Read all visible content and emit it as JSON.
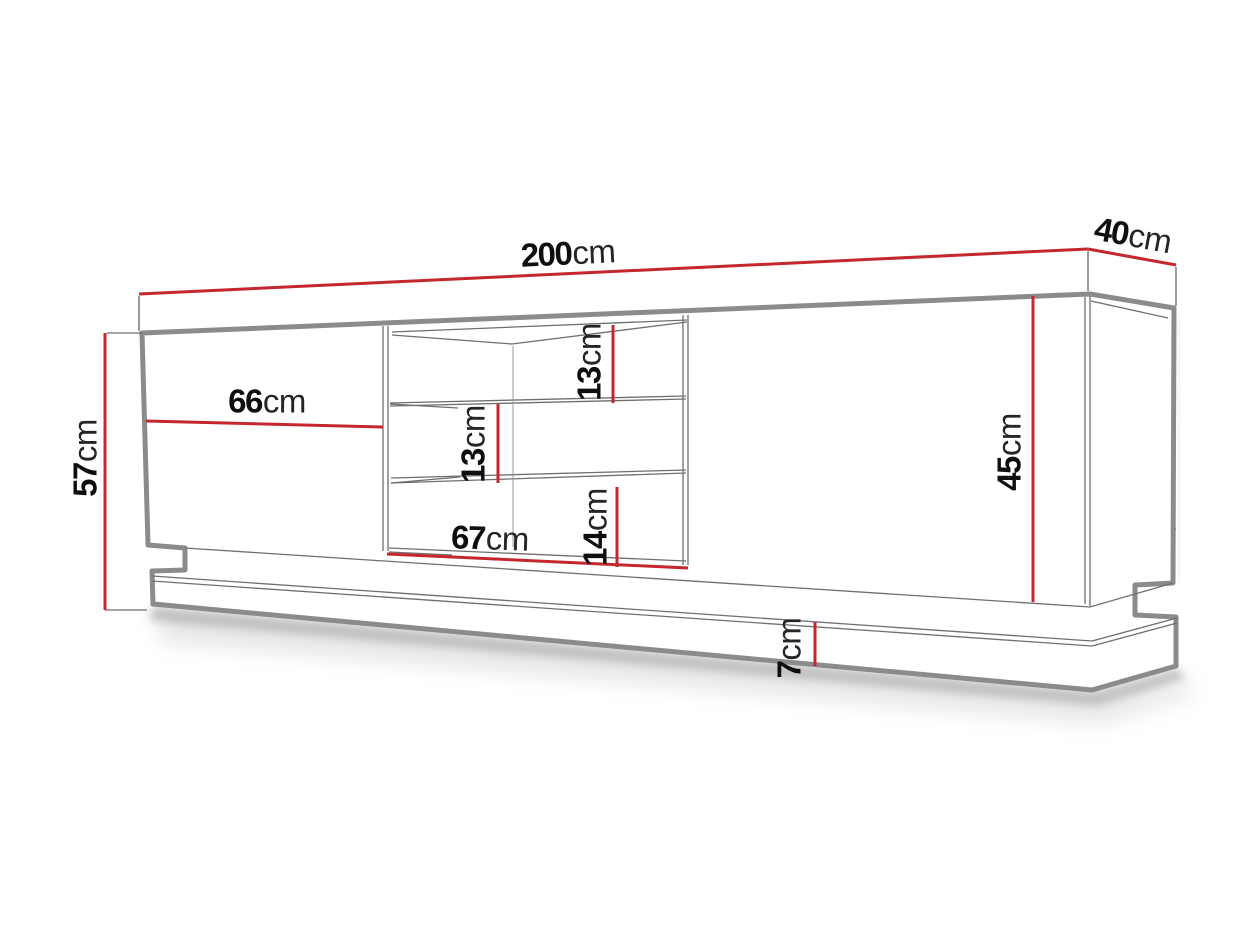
{
  "diagram": {
    "kind": "tv-stand dimension drawing",
    "accent_color": "#c4272e",
    "outline_color": "#8b8b8b",
    "thin_line_color": "#6f6f6f",
    "label_color": "#101010",
    "dimensions": {
      "total_width": {
        "value": "200",
        "unit": "cm"
      },
      "depth": {
        "value": "40",
        "unit": "cm"
      },
      "total_height": {
        "value": "57",
        "unit": "cm"
      },
      "left_door_width": {
        "value": "66",
        "unit": "cm"
      },
      "niche_width": {
        "value": "67",
        "unit": "cm"
      },
      "top_shelf_height": {
        "value": "13",
        "unit": "cm"
      },
      "middle_shelf_height": {
        "value": "13",
        "unit": "cm"
      },
      "bottom_shelf_height": {
        "value": "14",
        "unit": "cm"
      },
      "carcass_height": {
        "value": "45",
        "unit": "cm"
      },
      "plinth_height": {
        "value": "7",
        "unit": "cm"
      }
    }
  }
}
